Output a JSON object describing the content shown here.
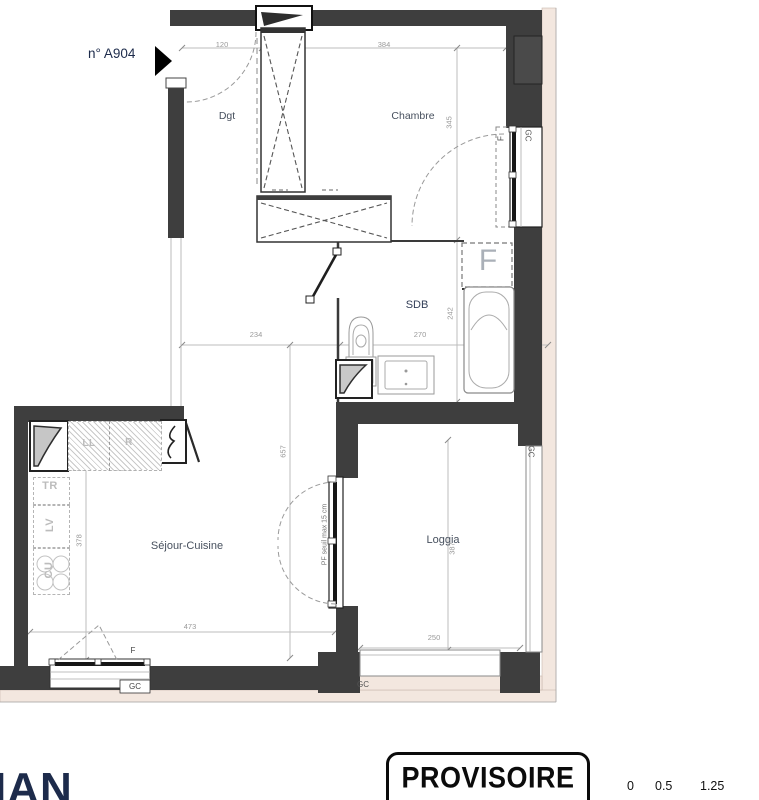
{
  "unit": {
    "label": "n° A904"
  },
  "rooms": {
    "dgt": "Dgt",
    "chambre": "Chambre",
    "sdb": "SDB",
    "sejour": "Séjour-Cuisine",
    "loggia": "Loggia"
  },
  "dims": {
    "entry_width": "120",
    "chambre_width": "384",
    "chambre_depth": "345",
    "sdb_depth": "242",
    "sdb_width": "270",
    "corridor_width": "234",
    "apartment_depth": "657",
    "kitchen_depth": "378",
    "sejour_width": "473",
    "loggia_depth": "387",
    "loggia_width": "250"
  },
  "marks": {
    "f": "F",
    "gc": "GC",
    "pf_note": "PF seuil max 15 cm"
  },
  "kitchen": {
    "ll": "LL",
    "r": "R",
    "tr": "TR",
    "lv": "LV",
    "cu": "CU"
  },
  "footer": {
    "logo": "IAN",
    "stamp": "PROVISOIRE",
    "scale": [
      "0",
      "0.5",
      "1.25"
    ]
  },
  "colors": {
    "wall": "#3e3e3e",
    "facade": "#f3e7df",
    "navy": "#1d2b4b",
    "dimline": "#bcbcbc"
  }
}
